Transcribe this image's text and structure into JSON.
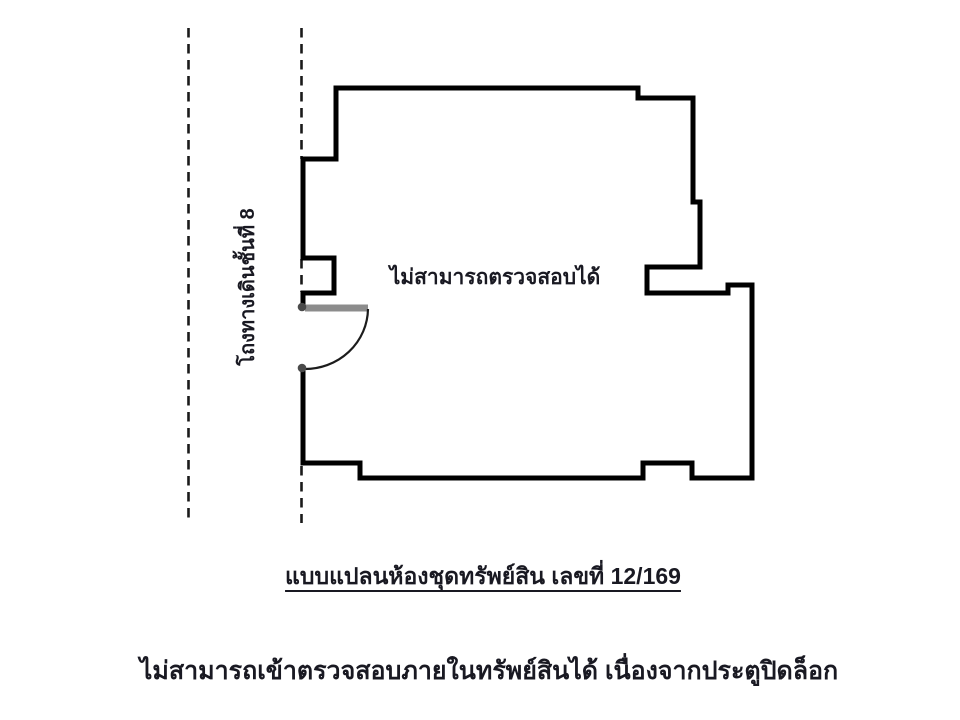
{
  "document": {
    "background_color": "#ffffff",
    "text_color": "#191922",
    "wall_color": "#000000",
    "door_leaf_color": "#8c8c8c",
    "dashed_line_color": "#1a1a1a"
  },
  "plan": {
    "corridor_label": "โถงทางเดินชั้นที่ 8",
    "room_label": "ไม่สามารถตรวจสอบได้",
    "caption": "แบบแปลนห้องชุดทรัพย์สิน เลขที่ 12/169",
    "unit_number": "12/169",
    "footnote": "ไม่สามารถเข้าตรวจสอบภายในทรัพย์สินได้ เนื่องจากประตูปิดล็อก"
  }
}
